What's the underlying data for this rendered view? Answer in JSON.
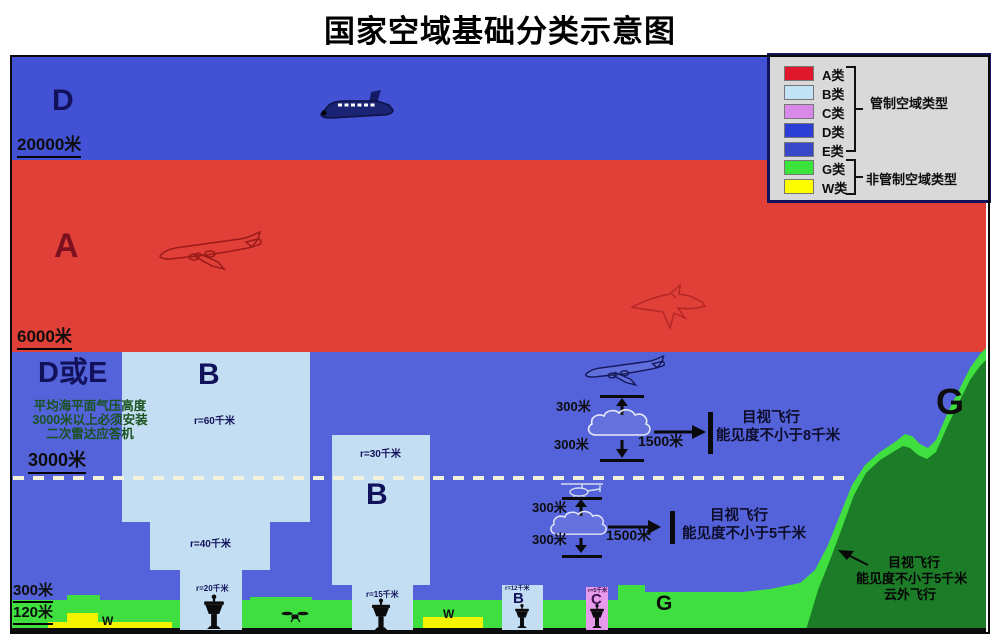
{
  "title": "国家空域基础分类示意图",
  "legend": {
    "items": [
      {
        "label": "A类",
        "color": "#e0182b"
      },
      {
        "label": "B类",
        "color": "#c2e2f5"
      },
      {
        "label": "C类",
        "color": "#d98ae8"
      },
      {
        "label": "D类",
        "color": "#2b3ed6"
      },
      {
        "label": "E类",
        "color": "#3948c9"
      },
      {
        "label": "G类",
        "color": "#3be43b"
      },
      {
        "label": "W类",
        "color": "#fdfd00"
      }
    ],
    "controlled": "管制空域类型",
    "uncontrolled": "非管制空域类型"
  },
  "zones": {
    "d_upper": "D",
    "a": "A",
    "d_or_e": "D或E",
    "g_mountain": "G",
    "g_surface": "G",
    "w_left": "W",
    "w_mid": "W"
  },
  "altitudes": {
    "m20000": "20000米",
    "m6000": "6000米",
    "m3000": "3000米",
    "m300": "300米",
    "m120": "120米"
  },
  "transponder_note": {
    "line1": "平均海平面气压高度",
    "line2": "3000米以上必须安装",
    "line3": "二次雷达应答机"
  },
  "approach_zones": {
    "b_large": {
      "label": "B",
      "r_upper": "r=60千米",
      "r_mid": "r=40千米",
      "r_lower": "r=20千米"
    },
    "b_medium": {
      "label": "B",
      "r_upper": "r=30千米",
      "r_lower": "r=15千米"
    },
    "b_small": {
      "label": "B",
      "r": "r=12千米"
    },
    "c_small": {
      "label": "C",
      "r": "r=5千米"
    }
  },
  "vfr_above_3000": {
    "cloud_above": "300米",
    "cloud_below": "300米",
    "horizontal": "1500米",
    "rule_line1": "目视飞行",
    "rule_line2": "能见度不小于8千米"
  },
  "vfr_below_3000": {
    "cloud_above": "300米",
    "cloud_below": "300米",
    "horizontal": "1500米",
    "rule_line1": "目视飞行",
    "rule_line2": "能见度不小于5千米"
  },
  "vfr_terrain": {
    "line1": "目视飞行",
    "line2": "能见度不小于5千米",
    "line3": "云外飞行"
  }
}
